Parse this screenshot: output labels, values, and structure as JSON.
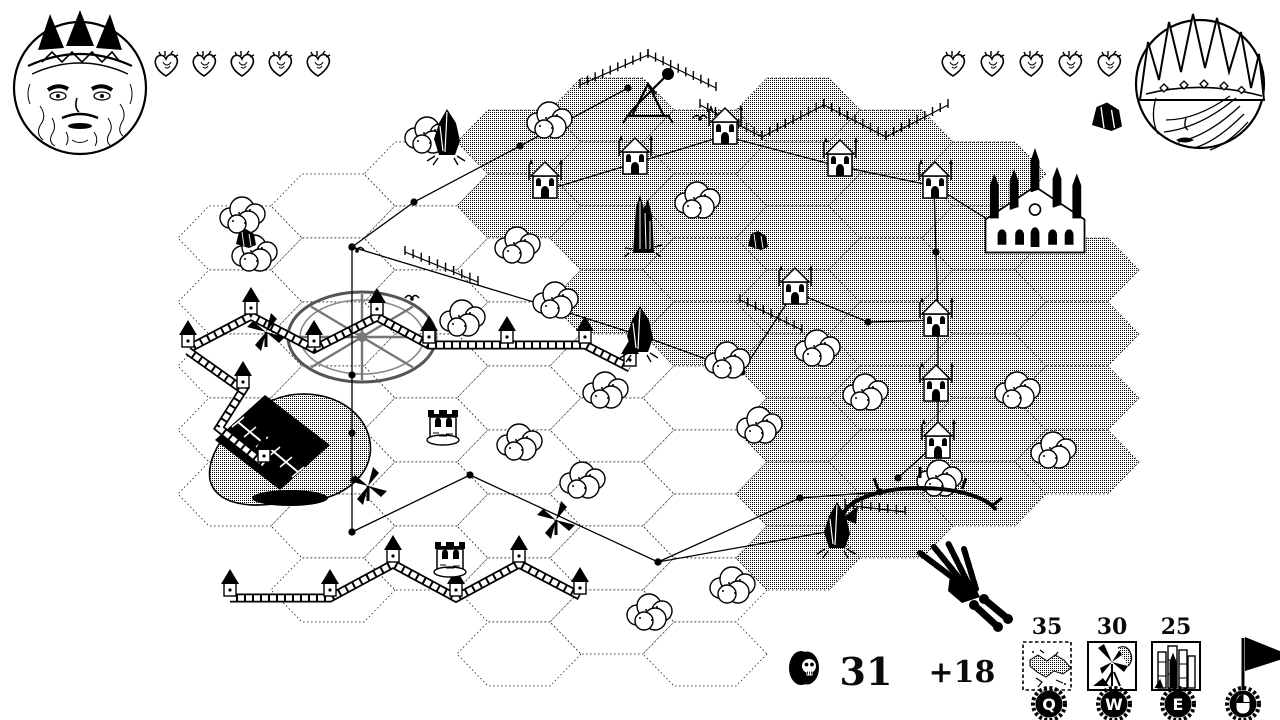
{
  "players": {
    "left": {
      "portrait": "bearded-king",
      "hearts": 5
    },
    "right": {
      "portrait": "crowned-queen",
      "hearts": 5,
      "resource_icon": "black-rock"
    }
  },
  "economy": {
    "coin_icon": "skull-coin",
    "gold": "31",
    "income": "+18"
  },
  "build_menu": {
    "items": [
      {
        "cost": "35",
        "hotkey": "Q",
        "icon": "terrain-patch"
      },
      {
        "cost": "30",
        "hotkey": "W",
        "icon": "windmill-building"
      },
      {
        "cost": "25",
        "hotkey": "E",
        "icon": "tower-cluster"
      }
    ],
    "flag": {
      "icon": "pennant-flag",
      "hotkey_icon": "mouse-left-click"
    }
  },
  "map": {
    "grid": {
      "origin_x": 240,
      "origin_y": 110,
      "col_step": 93,
      "row_step": 64,
      "odd_offset": 32,
      "hex_rx": 62,
      "hex_ry": 32
    },
    "columns": [
      {
        "c": 0,
        "r0": 2,
        "r1": 6,
        "dither": []
      },
      {
        "c": 1,
        "r0": 1,
        "r1": 7,
        "dither": []
      },
      {
        "c": 2,
        "r0": 1,
        "r1": 7,
        "dither": []
      },
      {
        "c": 3,
        "r0": 0,
        "r1": 8,
        "dither": [
          0,
          1
        ]
      },
      {
        "c": 4,
        "r0": 0,
        "r1": 8,
        "dither": [
          0,
          1,
          2,
          3
        ]
      },
      {
        "c": 5,
        "r0": 0,
        "r1": 8,
        "dither": [
          0,
          1,
          2,
          3
        ]
      },
      {
        "c": 6,
        "r0": 0,
        "r1": 7,
        "dither": [
          0,
          1,
          2,
          3,
          4,
          5,
          6,
          7
        ]
      },
      {
        "c": 7,
        "r0": 0,
        "r1": 6,
        "dither": [
          0,
          1,
          2,
          3,
          4,
          5,
          6
        ]
      },
      {
        "c": 8,
        "r0": 1,
        "r1": 6,
        "dither": [
          1,
          2,
          3,
          4,
          5,
          6
        ]
      },
      {
        "c": 9,
        "r0": 2,
        "r1": 5,
        "dither": [
          2,
          3,
          4,
          5
        ]
      }
    ],
    "walls": [
      {
        "pts": [
          [
            188,
            349
          ],
          [
            251,
            316
          ],
          [
            314,
            349
          ],
          [
            377,
            317
          ],
          [
            429,
            345
          ],
          [
            507,
            345
          ],
          [
            585,
            345
          ],
          [
            630,
            368
          ]
        ],
        "towers": [
          0,
          1,
          2,
          3,
          4,
          5,
          6,
          7
        ]
      },
      {
        "pts": [
          [
            188,
            351
          ],
          [
            243,
            390
          ],
          [
            219,
            428
          ],
          [
            264,
            464
          ]
        ],
        "towers": [
          1,
          3
        ]
      },
      {
        "pts": [
          [
            230,
            598
          ],
          [
            330,
            598
          ],
          [
            393,
            564
          ],
          [
            456,
            598
          ],
          [
            519,
            564
          ],
          [
            580,
            596
          ]
        ],
        "towers": [
          0,
          1,
          2,
          3,
          4,
          5
        ]
      }
    ],
    "fences": [
      [
        [
          580,
          85
        ],
        [
          648,
          55
        ]
      ],
      [
        [
          648,
          55
        ],
        [
          716,
          88
        ]
      ],
      [
        [
          700,
          105
        ],
        [
          762,
          137
        ]
      ],
      [
        [
          762,
          137
        ],
        [
          824,
          105
        ]
      ],
      [
        [
          824,
          105
        ],
        [
          886,
          137
        ]
      ],
      [
        [
          886,
          137
        ],
        [
          948,
          105
        ]
      ],
      [
        [
          405,
          252
        ],
        [
          478,
          282
        ]
      ],
      [
        [
          740,
          300
        ],
        [
          802,
          330
        ]
      ],
      [
        [
          845,
          505
        ],
        [
          905,
          512
        ]
      ]
    ],
    "paths": [
      [
        [
          628,
          88
        ],
        [
          520,
          146
        ],
        [
          414,
          202
        ],
        [
          352,
          247
        ]
      ],
      [
        [
          352,
          247
        ],
        [
          352,
          375
        ],
        [
          352,
          433
        ],
        [
          352,
          532
        ]
      ],
      [
        [
          352,
          247
        ],
        [
          560,
          310
        ],
        [
          648,
          338
        ]
      ],
      [
        [
          352,
          532
        ],
        [
          470,
          475
        ],
        [
          658,
          562
        ],
        [
          837,
          530
        ]
      ],
      [
        [
          658,
          562
        ],
        [
          800,
          498
        ],
        [
          880,
          492
        ]
      ],
      [
        [
          540,
          192
        ],
        [
          724,
          136
        ],
        [
          838,
          166
        ],
        [
          934,
          186
        ],
        [
          1008,
          232
        ]
      ],
      [
        [
          934,
          186
        ],
        [
          936,
          252
        ],
        [
          938,
          320
        ],
        [
          938,
          386
        ],
        [
          938,
          442
        ],
        [
          898,
          478
        ]
      ],
      [
        [
          794,
          292
        ],
        [
          868,
          322
        ],
        [
          938,
          320
        ]
      ],
      [
        [
          648,
          338
        ],
        [
          742,
          372
        ],
        [
          794,
          292
        ]
      ]
    ],
    "features": {
      "trees": [
        [
          245,
          215
        ],
        [
          257,
          253
        ],
        [
          430,
          135
        ],
        [
          552,
          120
        ],
        [
          520,
          245
        ],
        [
          465,
          318
        ],
        [
          558,
          300
        ],
        [
          700,
          200
        ],
        [
          608,
          390
        ],
        [
          522,
          442
        ],
        [
          585,
          480
        ],
        [
          730,
          360
        ],
        [
          820,
          348
        ],
        [
          868,
          392
        ],
        [
          762,
          425
        ],
        [
          1020,
          390
        ],
        [
          1056,
          450
        ],
        [
          942,
          478
        ],
        [
          735,
          585
        ],
        [
          652,
          612
        ]
      ],
      "chapels": [
        [
          545,
          182
        ],
        [
          635,
          158
        ],
        [
          725,
          128
        ],
        [
          840,
          160
        ],
        [
          935,
          182
        ],
        [
          795,
          288
        ],
        [
          936,
          320
        ],
        [
          936,
          385
        ],
        [
          938,
          442
        ]
      ],
      "cathedral": [
        1035,
        225
      ],
      "obelisk": [
        643,
        225
      ],
      "portals": [
        [
          447,
          135
        ],
        [
          640,
          332
        ],
        [
          837,
          528
        ]
      ],
      "windmills": [
        [
          266,
          332
        ],
        [
          368,
          486
        ],
        [
          556,
          520
        ]
      ],
      "rooks": [
        [
          443,
          425
        ],
        [
          450,
          557
        ]
      ],
      "wheel": [
        362,
        337
      ],
      "barn": [
        300,
        450
      ],
      "trebuchet": [
        648,
        96
      ],
      "birds": [
        [
          357,
          252
        ],
        [
          412,
          300
        ],
        [
          700,
          120
        ]
      ],
      "rocks": [
        [
          246,
          238
        ],
        [
          758,
          240
        ]
      ],
      "hand": [
        950,
        575
      ],
      "arc": [
        920,
        508
      ]
    }
  }
}
